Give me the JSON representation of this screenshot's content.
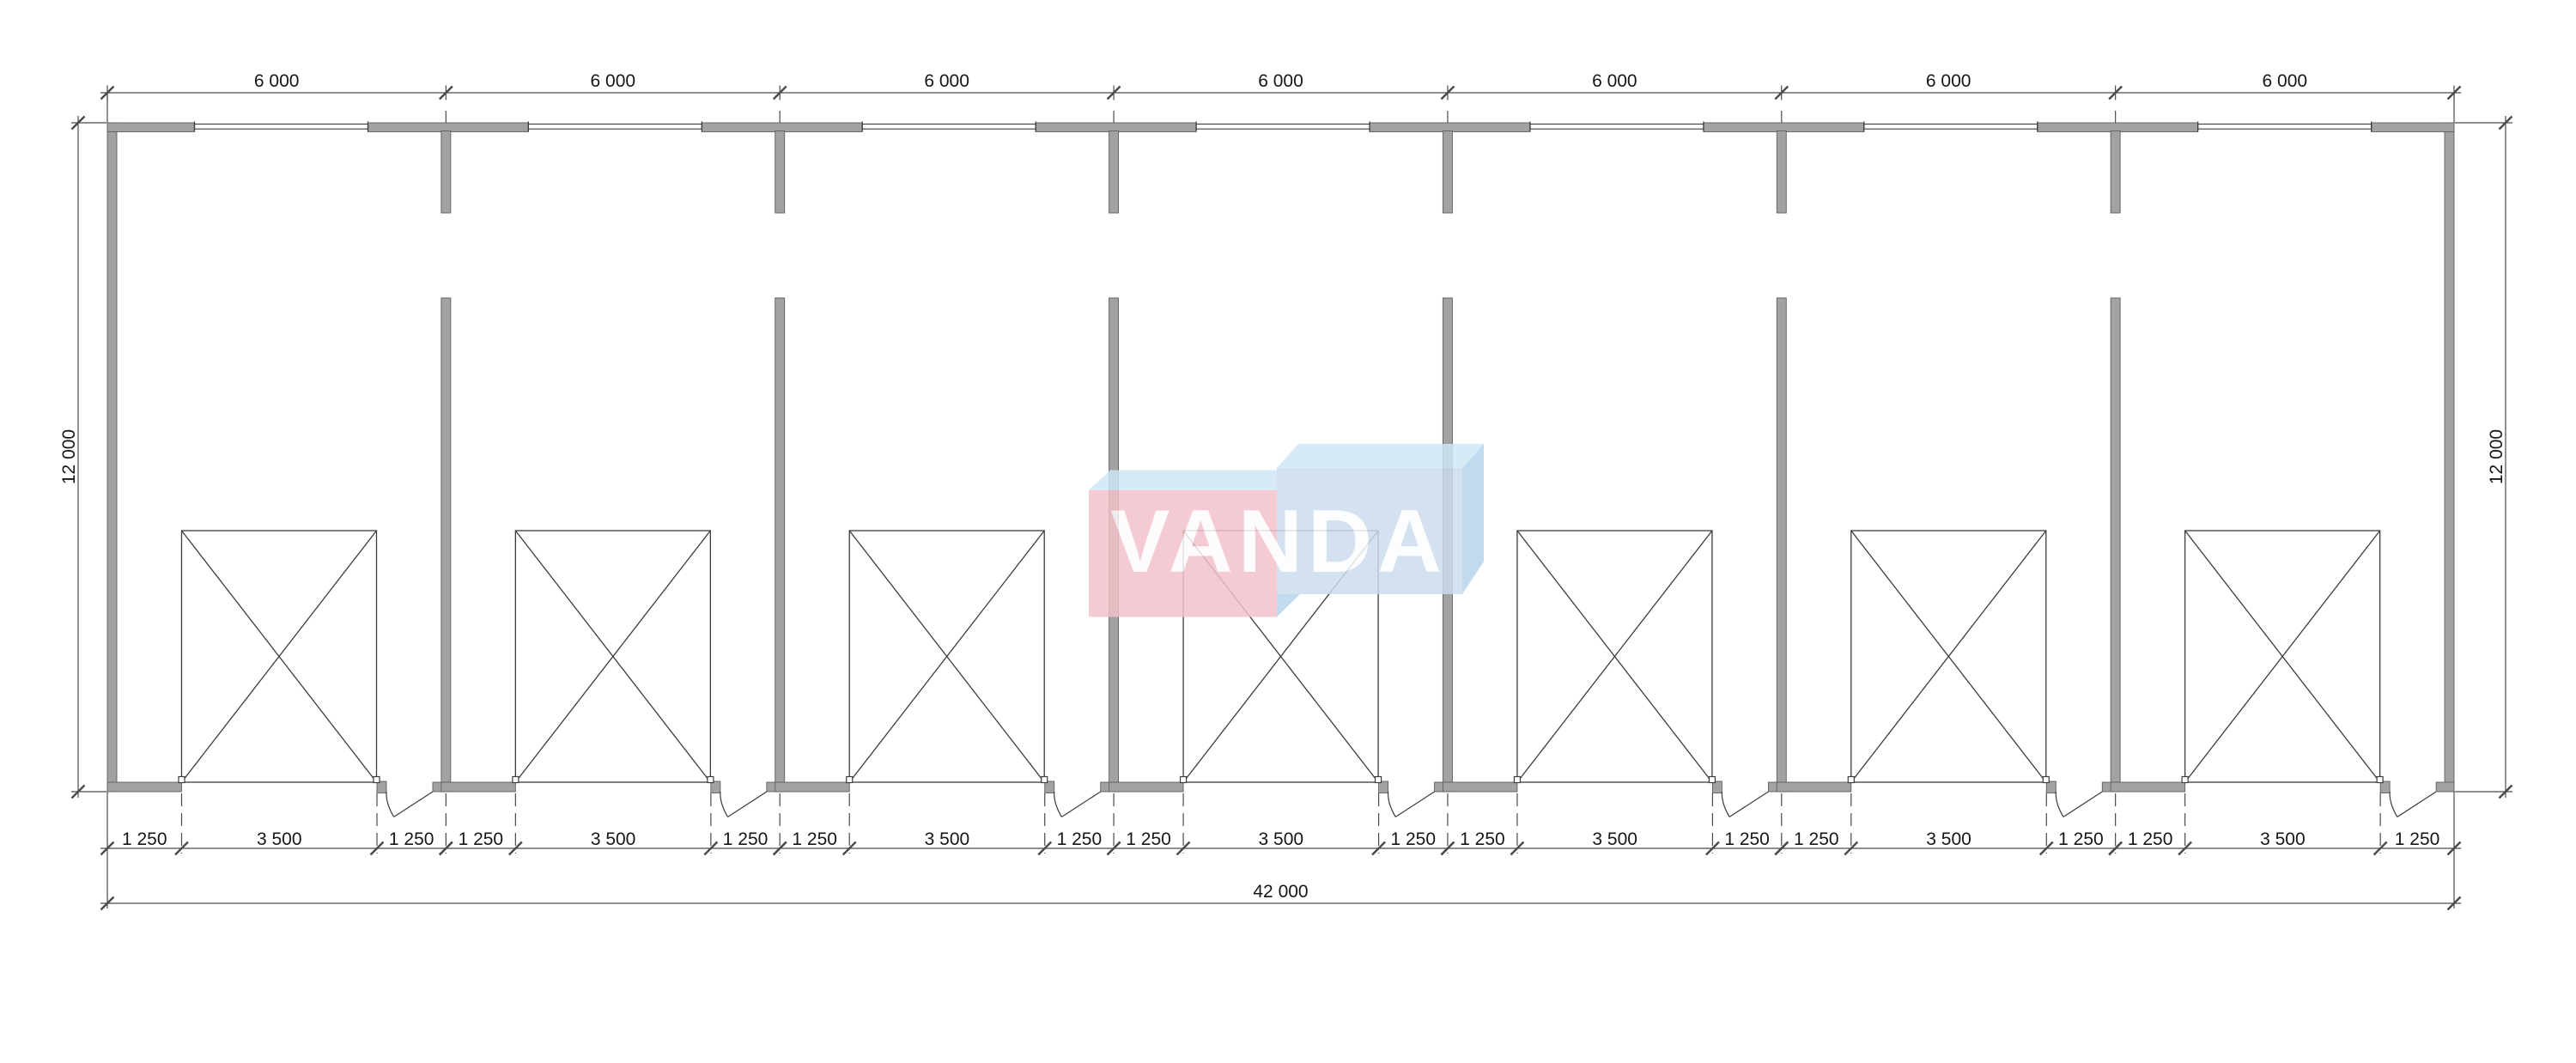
{
  "page": {
    "background": "#ffffff"
  },
  "drawing": {
    "type": "floor-plan",
    "logo_text": "VANDA",
    "bays": 7,
    "dim_top_labels": [
      "6 000",
      "6 000",
      "6 000",
      "6 000",
      "6 000",
      "6 000",
      "6 000"
    ],
    "dim_bottom_segment_labels": [
      "1 250",
      "3 500",
      "1 250"
    ],
    "dim_total_label": "42 000",
    "dim_left_label": "12 000",
    "dim_right_label": "12 000",
    "units_mm": {
      "bay_width": 6000,
      "building_width": 42000,
      "building_depth": 12000,
      "garage_opening_width": 3500,
      "side_segment": 1250
    },
    "colors": {
      "wall_fill": "#a2a2a2",
      "wall_edge": "#5f5f5f",
      "line": "#3c3c3c",
      "dim_line": "#4a4a4a",
      "text": "#161616",
      "logo_pink": "#f3c2ca",
      "logo_blue_front": "#cbdcee",
      "logo_blue_top": "#cfe7f7",
      "logo_blue_side": "#b4d4ee",
      "logo_text_fill": "#ffffff"
    }
  }
}
